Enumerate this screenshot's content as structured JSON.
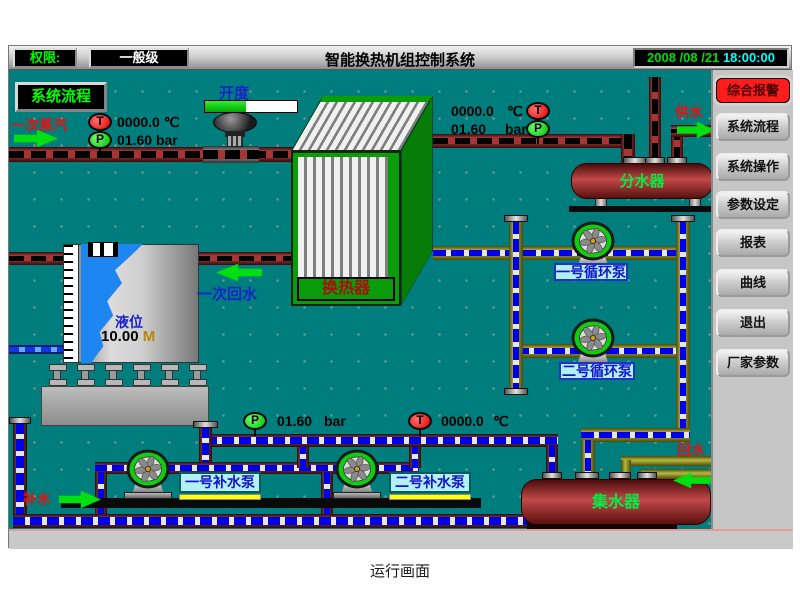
{
  "window": {
    "titlebar": {
      "permission_label": "权限:",
      "permission_level": "一般级",
      "title": "智能换热机组控制系统",
      "date": "2008 /08 /21",
      "time": "18:00:00"
    },
    "sidebar": {
      "alarm": "综合报警",
      "buttons": [
        "系统流程",
        "系统操作",
        "参数设定",
        "报表",
        "曲线",
        "退出",
        "厂家参数"
      ]
    },
    "diagram": {
      "flow_page_button": "系统流程",
      "primary_steam_label": "一次蒸汽",
      "primary_return_label": "一次回水",
      "valve_opening_label": "开度",
      "valve_opening_percent": 45,
      "supply_label": "供水",
      "return_label": "回水",
      "makeup_label": "补水",
      "heat_exchanger_label": "换热器",
      "distributor_label": "分水器",
      "collector_label": "集水器",
      "tank": {
        "level_label": "液位",
        "level_value": "10.00",
        "level_unit": "M"
      },
      "gauges": {
        "steam_temp": {
          "letter": "T",
          "value": "0000.0",
          "unit": "℃"
        },
        "steam_pressure": {
          "letter": "P",
          "value": "01.60",
          "unit": "bar"
        },
        "supply_temp": {
          "letter": "T",
          "value": "0000.0",
          "unit": "℃"
        },
        "supply_pressure": {
          "letter": "P",
          "value": "01.60",
          "unit": "bar"
        },
        "makeup_pressure": {
          "letter": "P",
          "value": "01.60",
          "unit": "bar"
        },
        "return_temp": {
          "letter": "T",
          "value": "0000.0",
          "unit": "℃"
        }
      },
      "pumps": {
        "circulation_1": "一号循环泵",
        "circulation_2": "二号循环泵",
        "makeup_1": "一号补水泵",
        "makeup_2": "二号补水泵"
      }
    }
  },
  "caption": "运行画面"
}
